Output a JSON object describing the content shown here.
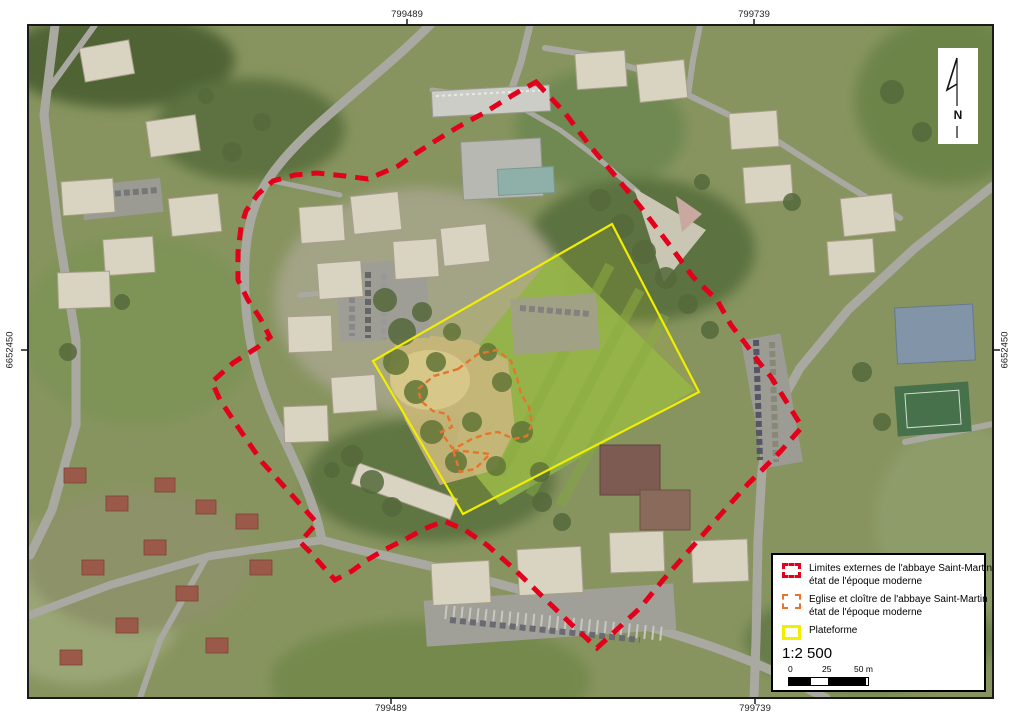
{
  "map": {
    "coordinates": {
      "top_left": "799489",
      "top_right": "799739",
      "bottom_left": "799489",
      "bottom_right": "799739",
      "left": "6652450",
      "right": "6652450"
    },
    "north": {
      "label": "N"
    }
  },
  "legend": {
    "items": [
      {
        "symbol": "red-dashed",
        "line1": "Limites externes de l'abbaye Saint-Martin",
        "line2": "état de l'époque moderne",
        "color": "#e3001b"
      },
      {
        "symbol": "orange-dashed",
        "line1": "Eglise et cloître de l'abbaye Saint-Martin",
        "line2": "état de l'époque moderne",
        "color": "#e4752b"
      },
      {
        "symbol": "yellow-solid",
        "line1": "Plateforme",
        "line2": "",
        "color": "#f1ee00"
      }
    ],
    "scale": {
      "ratio_text": "1:2 500",
      "bar_labels": [
        "0",
        "25",
        "50 m"
      ]
    }
  },
  "overlays": {
    "outer_limit": {
      "color": "#e3001b",
      "points": [
        [
          536,
          82
        ],
        [
          565,
          113
        ],
        [
          590,
          146
        ],
        [
          617,
          178
        ],
        [
          643,
          210
        ],
        [
          668,
          243
        ],
        [
          693,
          277
        ],
        [
          717,
          300
        ],
        [
          731,
          325
        ],
        [
          745,
          343
        ],
        [
          758,
          361
        ],
        [
          771,
          377
        ],
        [
          786,
          401
        ],
        [
          802,
          427
        ],
        [
          780,
          452
        ],
        [
          748,
          484
        ],
        [
          722,
          513
        ],
        [
          693,
          546
        ],
        [
          663,
          580
        ],
        [
          640,
          608
        ],
        [
          610,
          636
        ],
        [
          597,
          648
        ],
        [
          570,
          623
        ],
        [
          543,
          597
        ],
        [
          513,
          568
        ],
        [
          487,
          545
        ],
        [
          465,
          530
        ],
        [
          444,
          521
        ],
        [
          424,
          529
        ],
        [
          404,
          540
        ],
        [
          386,
          549
        ],
        [
          367,
          560
        ],
        [
          352,
          571
        ],
        [
          335,
          580
        ],
        [
          310,
          552
        ],
        [
          300,
          542
        ],
        [
          317,
          523
        ],
        [
          290,
          493
        ],
        [
          262,
          462
        ],
        [
          240,
          430
        ],
        [
          220,
          400
        ],
        [
          212,
          382
        ],
        [
          233,
          363
        ],
        [
          258,
          347
        ],
        [
          270,
          337
        ],
        [
          260,
          318
        ],
        [
          248,
          300
        ],
        [
          238,
          280
        ],
        [
          238,
          252
        ],
        [
          241,
          227
        ],
        [
          246,
          211
        ],
        [
          258,
          194
        ],
        [
          273,
          181
        ],
        [
          295,
          175
        ],
        [
          317,
          173
        ],
        [
          345,
          176
        ],
        [
          368,
          179
        ],
        [
          398,
          166
        ],
        [
          415,
          154
        ],
        [
          432,
          143
        ],
        [
          448,
          133
        ],
        [
          465,
          123
        ],
        [
          484,
          113
        ],
        [
          500,
          103
        ],
        [
          518,
          92
        ]
      ]
    },
    "church_cloister": {
      "color": "#e4752b",
      "paths": [
        "M458,369 L478,354 L497,350 L511,361 L517,378 L521,394 L529,407 L532,424 L527,436 L514,439 L498,432 L486,434 L472,439 L459,446 L452,448 L441,432 L452,427 L447,414 L433,411 L421,401 L418,389 L434,376 Z",
        "M453,450 L490,454 L475,469 L460,472 Z"
      ]
    },
    "platform": {
      "color": "#f1ee00",
      "points": [
        [
          612,
          224
        ],
        [
          699,
          392
        ],
        [
          463,
          514
        ],
        [
          373,
          361
        ]
      ]
    }
  }
}
